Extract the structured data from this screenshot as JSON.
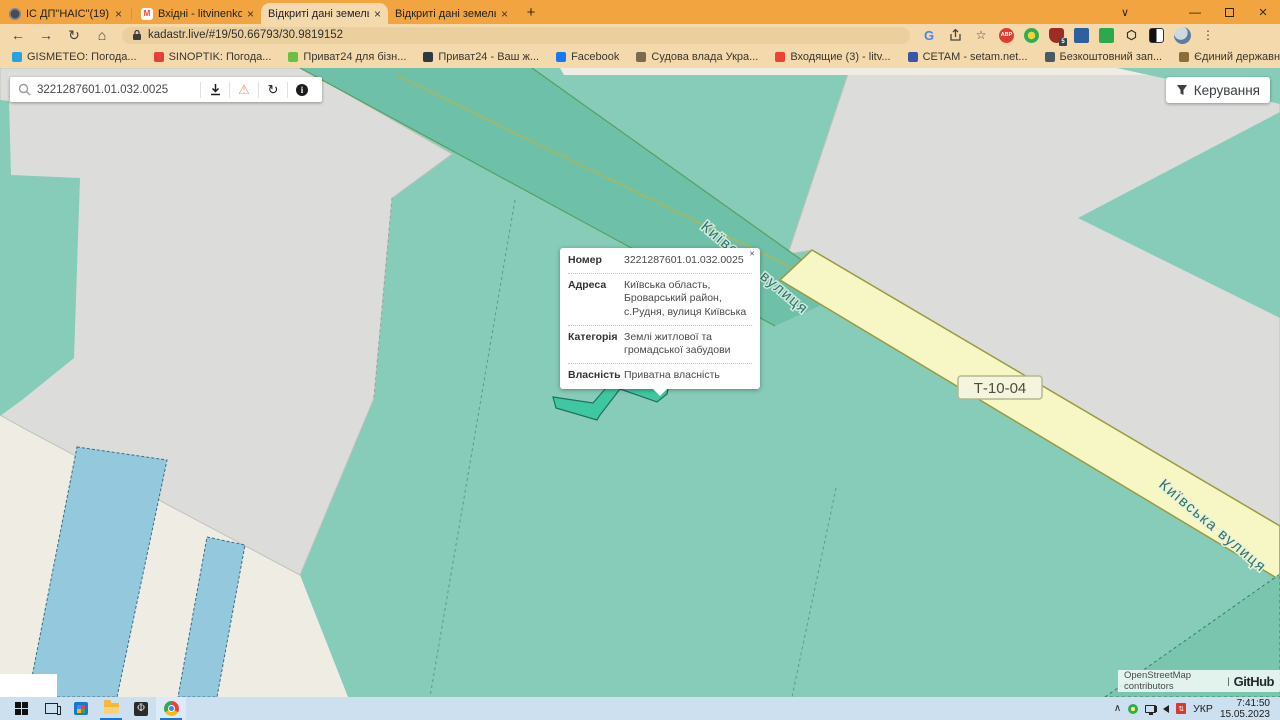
{
  "browser": {
    "tabs": [
      {
        "title": "ІС ДП\"НАІС\"(19)"
      },
      {
        "title": "Вхідні - litvinenkoa787@gmail.c"
      },
      {
        "title": "Відкриті дані земельного кадас"
      },
      {
        "title": "Відкриті дані земельного кадас"
      }
    ],
    "close_glyph": "×",
    "new_tab_glyph": "+",
    "url": "kadastr.live/#19/50.66793/30.9819152",
    "bookmarks": [
      {
        "label": "GISMETEO: Погода...",
        "icon_style": "background:#2aa3dc"
      },
      {
        "label": "SINOPTIK: Погода...",
        "icon_style": "background:#e2413c"
      },
      {
        "label": "Приват24 для бізн...",
        "icon_style": "background:#6cbf44"
      },
      {
        "label": "Приват24 - Ваш ж...",
        "icon_style": "background:#2f3a40"
      },
      {
        "label": "Facebook",
        "icon_style": "background:#1877f2"
      },
      {
        "label": "Судова влада Укра...",
        "icon_style": "background:#7a6a50"
      },
      {
        "label": "Входящие (3) - litv...",
        "icon_style": "background:#ea4335"
      },
      {
        "label": "CETAM - setam.net...",
        "icon_style": "background:#3a57a5"
      },
      {
        "label": "Безкоштовний зап...",
        "icon_style": "background:#4a5a62"
      },
      {
        "label": "Єдиний державни...",
        "icon_style": "background:#8a6d3b"
      },
      {
        "label": "mail.gov.ua : Mail.g...",
        "icon_style": "background:#2196d8"
      },
      {
        "label": "Вхідні • litvinenkoa...",
        "icon_style": "background:#3fae49"
      }
    ],
    "bookmarks_overflow": "»"
  },
  "page": {
    "search_value": "3221287601.01.032.0025",
    "manage_label": "Керування",
    "popup": {
      "close_glyph": "✕",
      "rows": [
        {
          "label": "Номер",
          "value": "3221287601.01.032.0025"
        },
        {
          "label": "Адреса",
          "value": "Київська область, Броварський район, с.Рудня, вулиця Київська"
        },
        {
          "label": "Категорія",
          "value": "Землі житлової та громадської забудови"
        },
        {
          "label": "Власність",
          "value": "Приватна власність"
        }
      ]
    },
    "map": {
      "street_label": "Київська вулиця",
      "street_label_2": "Київська вулиця",
      "route_badge": "Т-10-04",
      "attribution": "OpenStreetMap contributors",
      "attribution_divider": "|",
      "attribution_brand": "GitHub"
    },
    "colors": {
      "parcel_teal": "#86ccb8",
      "parcel_teal_dark": "#7ac5ae",
      "road_band_teal": "#6ec1a8",
      "parcel_blue": "#93c8dd",
      "road_yellow": "#f7f7c5",
      "selected_parcel": "#3fc7a1",
      "nodata_gray": "#dcdcda",
      "background_beige": "#efece3"
    }
  },
  "taskbar": {
    "lang": "УКР",
    "time": "7:41:50",
    "date": "15.05.2023"
  }
}
